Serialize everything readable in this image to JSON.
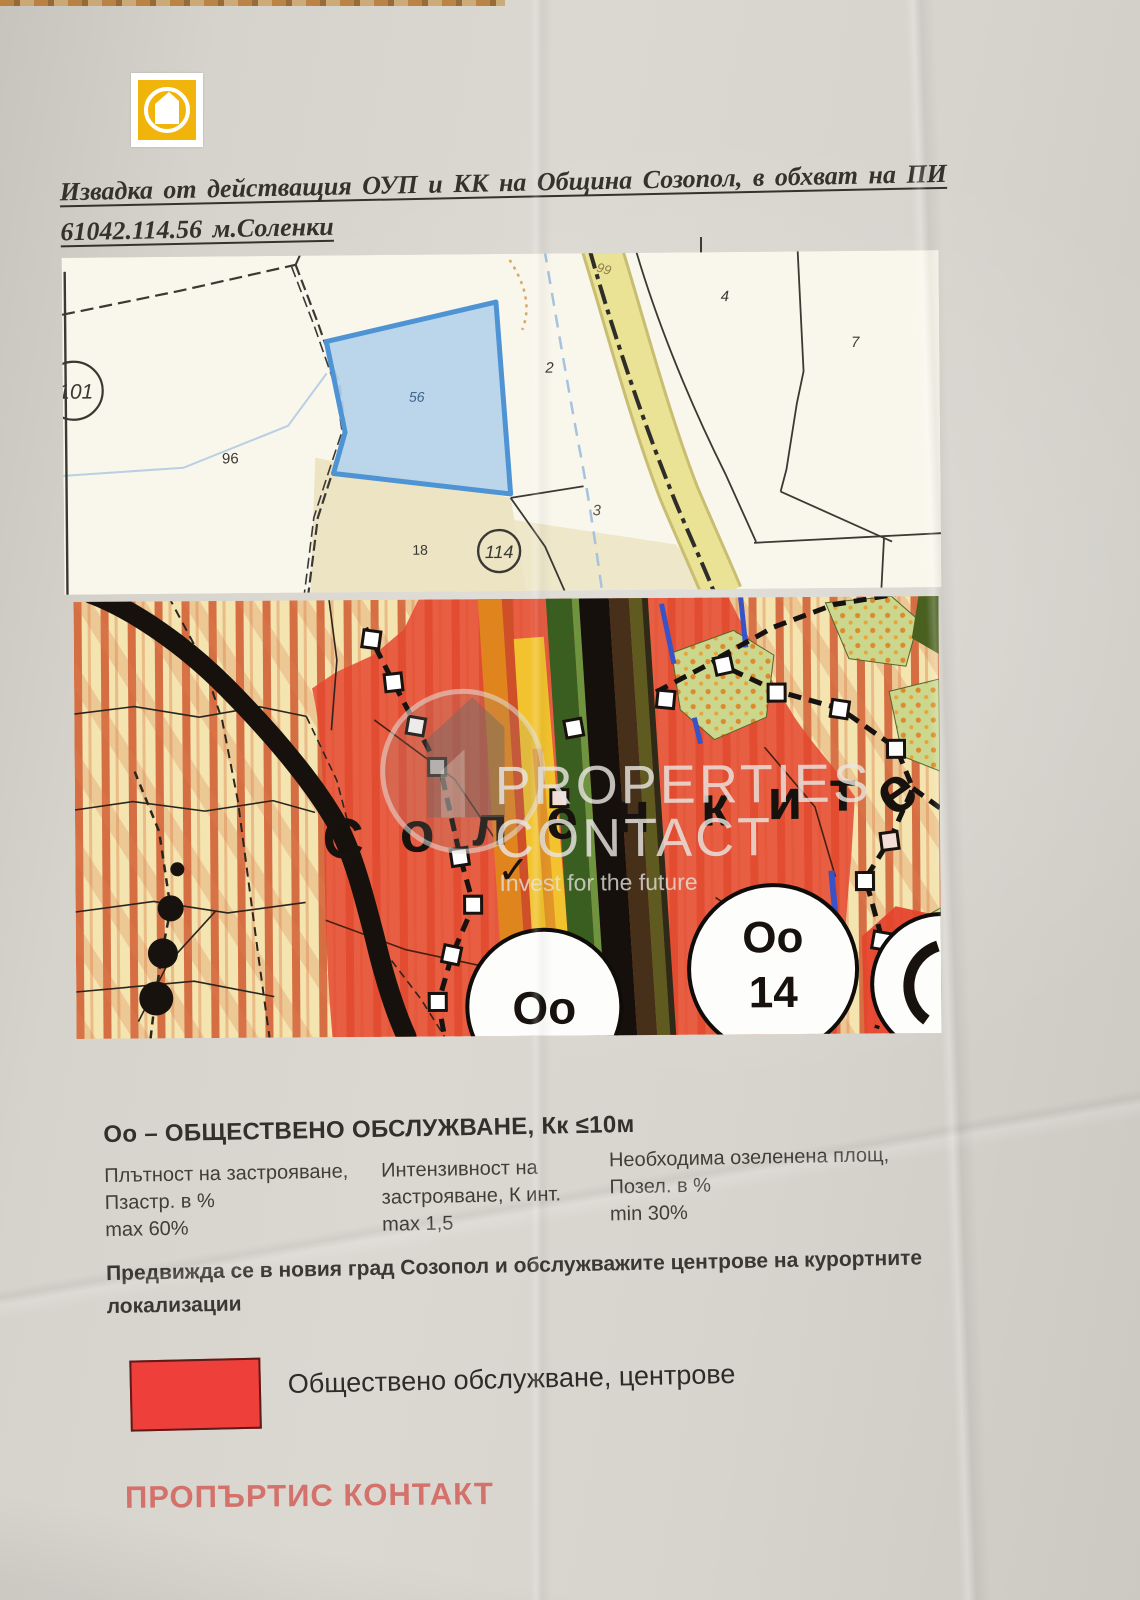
{
  "page": {
    "title_line1": "Извадка от действащия ОУП и КК на Община Созопол, в обхват на ПИ",
    "title_line2": "61042.114.56 м.Соленки",
    "footer_brand": "ПРОПЪРТИС КОНТАКТ"
  },
  "logo": {
    "color": "#f1b40a"
  },
  "cadastral_map": {
    "highlight_fill": "#b5d2ea",
    "highlight_border": "#4e94d4",
    "labels": {
      "p101": "101",
      "p96": "96",
      "p56": "56",
      "p2": "2",
      "p3": "3",
      "p4": "4",
      "p7": "7",
      "p18": "18",
      "p114": "114",
      "road99": "99"
    }
  },
  "zoning_map": {
    "area_name": "Соленките",
    "letters": [
      "С",
      "о",
      "л",
      "е",
      "н",
      "к",
      "и",
      "т",
      "е"
    ],
    "circle1_label": "Оо",
    "circle2_line1": "Оо",
    "circle2_line2": "14",
    "checkmark": "✓",
    "zone_red": "#e5452d",
    "watermark": {
      "line1": "PROPERTIES",
      "line2": "CONTACT",
      "tagline": "Invest for the future"
    }
  },
  "regulations": {
    "heading": "Оо – ОБЩЕСТВЕНО ОБСЛУЖВАНЕ, Кк ≤10м",
    "columns": [
      {
        "line1": "Плътност на застрояване,",
        "line2": "Пзастр. в %",
        "line3": "max 60%"
      },
      {
        "line1": "Интензивност на",
        "line2": "застрояване, К инт.",
        "line3": "max 1,5"
      },
      {
        "line1": "Необходима озеленена площ,",
        "line2": "Позел. в %",
        "line3": "min 30%"
      }
    ],
    "note_line1": "Предвижда се в новия град Созопол и обслужважите центрове на курортните",
    "note_line2": "локализации"
  },
  "legend": {
    "swatch_color": "#ee3f3b",
    "label": "Обществено обслужване, центрове"
  }
}
